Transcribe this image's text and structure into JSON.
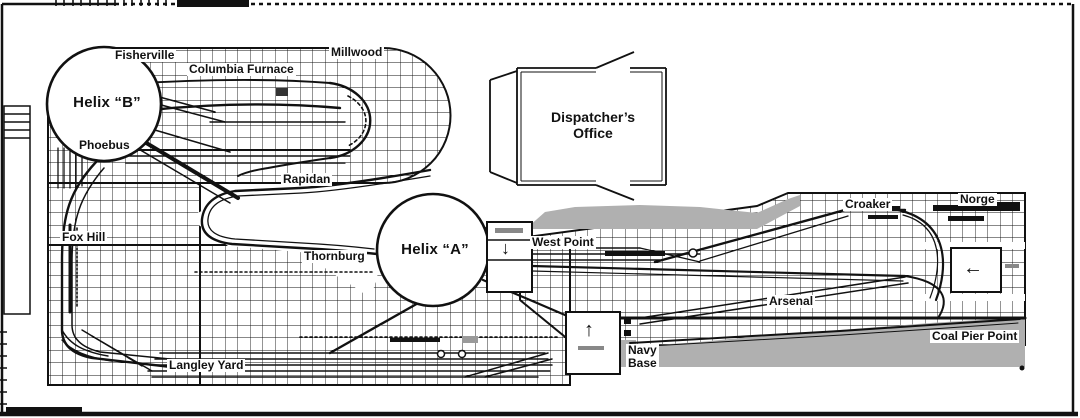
{
  "diagram": {
    "kind": "model-railroad-track-plan",
    "places": {
      "fisherville": "Fisherville",
      "columbia_furnace": "Columbia Furnace",
      "millwood": "Millwood",
      "helix_b": "Helix “B”",
      "phoebus": "Phoebus",
      "rapidan": "Rapidan",
      "fox_hill": "Fox Hill",
      "thornburg": "Thornburg",
      "helix_a": "Helix “A”",
      "langley_yard": "Langley Yard",
      "west_point": "West Point",
      "croaker": "Croaker",
      "norge": "Norge",
      "arsenal": "Arsenal",
      "navy_base_line1": "Navy",
      "navy_base_line2": "Base",
      "coal_pier_point": "Coal Pier Point"
    },
    "rooms": {
      "dispatchers_office_line1": "Dispatcher’s",
      "dispatchers_office_line2": "Office"
    },
    "icons": {
      "down_arrow": "↓",
      "up_arrow": "↑",
      "left_arrow": "←"
    },
    "colors": {
      "ink": "#111111",
      "backdrop_gray": "#b0b0b0",
      "paper": "#ffffff"
    }
  }
}
